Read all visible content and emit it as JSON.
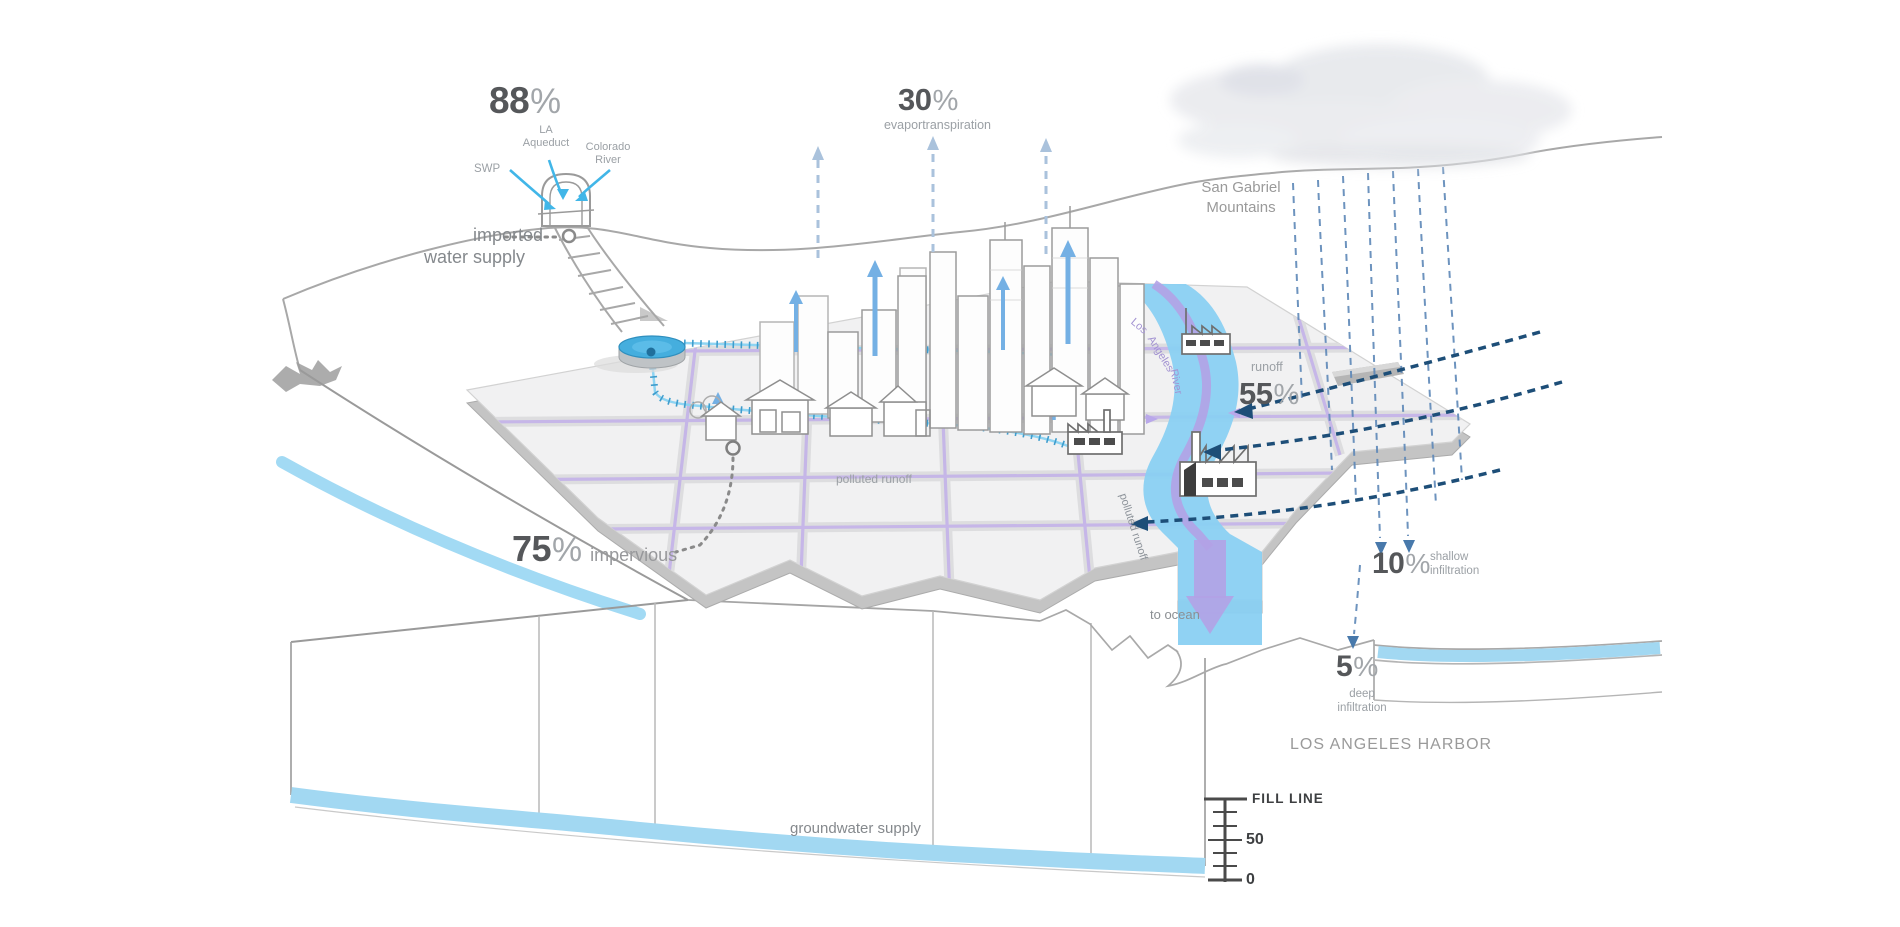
{
  "colors": {
    "water_blue": "#8ad0f2",
    "pipe_blue": "#41b6e8",
    "channel_purple": "#b3a2e6",
    "street_lavender": "#c4b4e8",
    "rain_blue": "#5e88b8",
    "runoff_navy": "#1d4e78",
    "evap_blue": "#aac2dc",
    "number_gray": "#55575a",
    "label_gray": "#9ba0a5"
  },
  "stats": {
    "imported": {
      "value": "88",
      "unit": "%"
    },
    "evapotranspiration": {
      "value": "30",
      "unit": "%",
      "label": "evaportranspiration"
    },
    "runoff": {
      "value": "55",
      "unit": "%",
      "label": "runoff"
    },
    "impervious": {
      "value": "75",
      "unit": "%",
      "label": "impervious"
    },
    "shallow_infiltration": {
      "value": "10",
      "unit": "%",
      "label_line1": "shallow",
      "label_line2": "infiltration"
    },
    "deep_infiltration": {
      "value": "5",
      "unit": "%",
      "label_line1": "deep",
      "label_line2": "infiltration"
    }
  },
  "imported_sources": {
    "swp": "SWP",
    "la_line1": "LA",
    "la_line2": "Aqueduct",
    "colorado_line1": "Colorado",
    "colorado_line2": "River",
    "caption_line1": "imported",
    "caption_line2": "water supply"
  },
  "geography": {
    "mountains_line1": "San Gabriel",
    "mountains_line2": "Mountains",
    "harbor": "LOS ANGELES HARBOR",
    "groundwater": "groundwater supply",
    "to_ocean": "to ocean"
  },
  "river": {
    "word1": "Los",
    "word2": "Angeles",
    "word3": "River",
    "polluted_river": "polluted runoff",
    "polluted_street": "polluted runoff"
  },
  "gauge": {
    "title": "FILL LINE",
    "mid": "50",
    "bottom": "0"
  }
}
